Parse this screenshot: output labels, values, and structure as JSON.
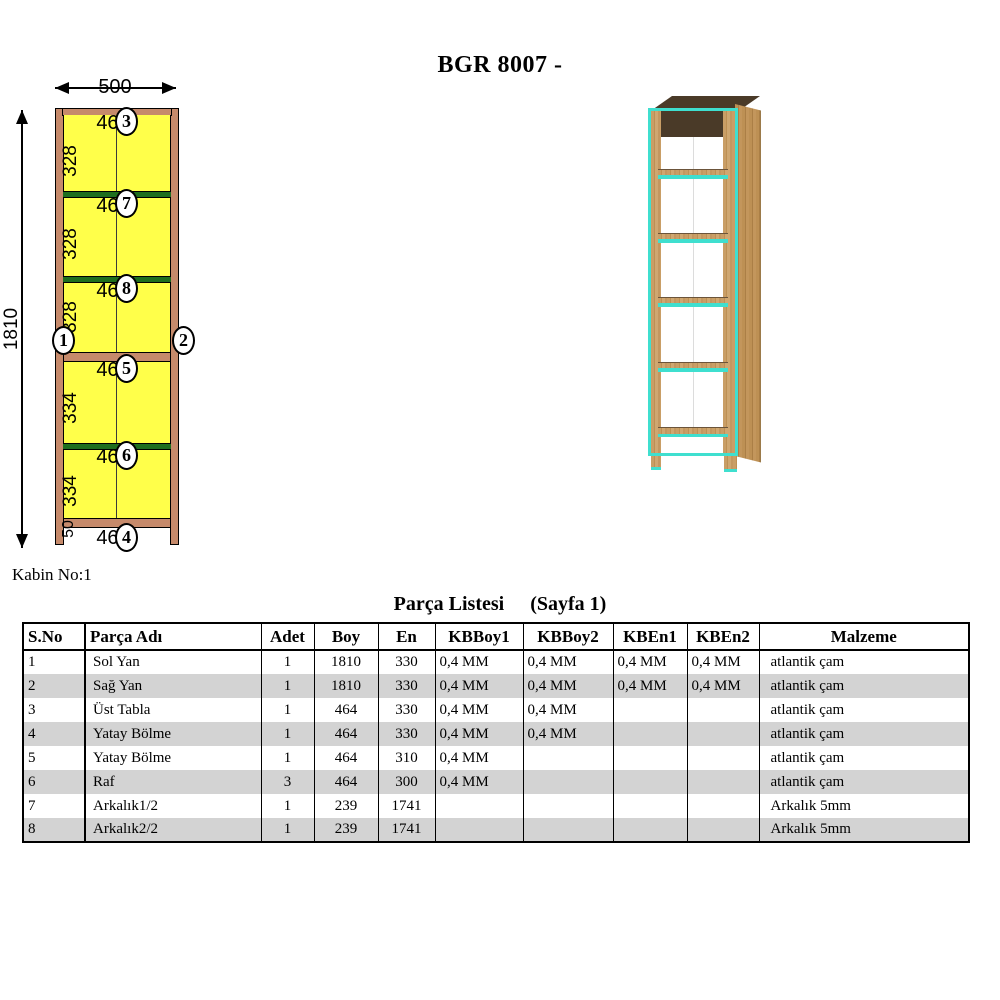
{
  "title": "BGR 8007 -",
  "cabin_label": "Kabin No:1",
  "diagram": {
    "dims": {
      "width": "500",
      "height": "1810"
    },
    "markers": {
      "left": "1",
      "right": "2"
    },
    "sections": [
      {
        "h": "328",
        "w": "464",
        "c": "3"
      },
      {
        "h": "328",
        "w": "464",
        "c": "7"
      },
      {
        "h": "328",
        "w": "464",
        "c": "8"
      },
      {
        "h": "334",
        "w": "464",
        "c": "5"
      },
      {
        "h": "334",
        "w": "464",
        "c": "6"
      },
      {
        "h": "50",
        "w": "464",
        "c": "4"
      }
    ],
    "colors": {
      "panel_yellow": "#ffff4a",
      "frame_tan": "#c68a6b",
      "shelf_green": "#1e6e1e"
    }
  },
  "render3d": {
    "colors": {
      "wood": "#c99e66",
      "edge_cyan": "#3fdfcf",
      "interior_dark": "#4a3a28"
    }
  },
  "table": {
    "title_main": "Parça Listesi",
    "title_page": "(Sayfa 1)",
    "headers": [
      "S.No",
      "Parça Adı",
      "Adet",
      "Boy",
      "En",
      "KBBoy1",
      "KBBoy2",
      "KBEn1",
      "KBEn2",
      "Malzeme"
    ],
    "rows": [
      [
        "1",
        "Sol Yan",
        "1",
        "1810",
        "330",
        "0,4 MM",
        "0,4 MM",
        "0,4 MM",
        "0,4 MM",
        "atlantik çam"
      ],
      [
        "2",
        "Sağ Yan",
        "1",
        "1810",
        "330",
        "0,4 MM",
        "0,4 MM",
        "0,4 MM",
        "0,4 MM",
        "atlantik çam"
      ],
      [
        "3",
        "Üst Tabla",
        "1",
        "464",
        "330",
        "0,4 MM",
        "0,4 MM",
        "",
        "",
        "atlantik çam"
      ],
      [
        "4",
        "Yatay Bölme",
        "1",
        "464",
        "330",
        "0,4 MM",
        "0,4 MM",
        "",
        "",
        "atlantik çam"
      ],
      [
        "5",
        "Yatay Bölme",
        "1",
        "464",
        "310",
        "0,4 MM",
        "",
        "",
        "",
        "atlantik çam"
      ],
      [
        "6",
        "Raf",
        "3",
        "464",
        "300",
        "0,4 MM",
        "",
        "",
        "",
        "atlantik çam"
      ],
      [
        "7",
        "Arkalık1/2",
        "1",
        "239",
        "1741",
        "",
        "",
        "",
        "",
        "Arkalık 5mm"
      ],
      [
        "8",
        "Arkalık2/2",
        "1",
        "239",
        "1741",
        "",
        "",
        "",
        "",
        "Arkalık 5mm"
      ]
    ]
  }
}
